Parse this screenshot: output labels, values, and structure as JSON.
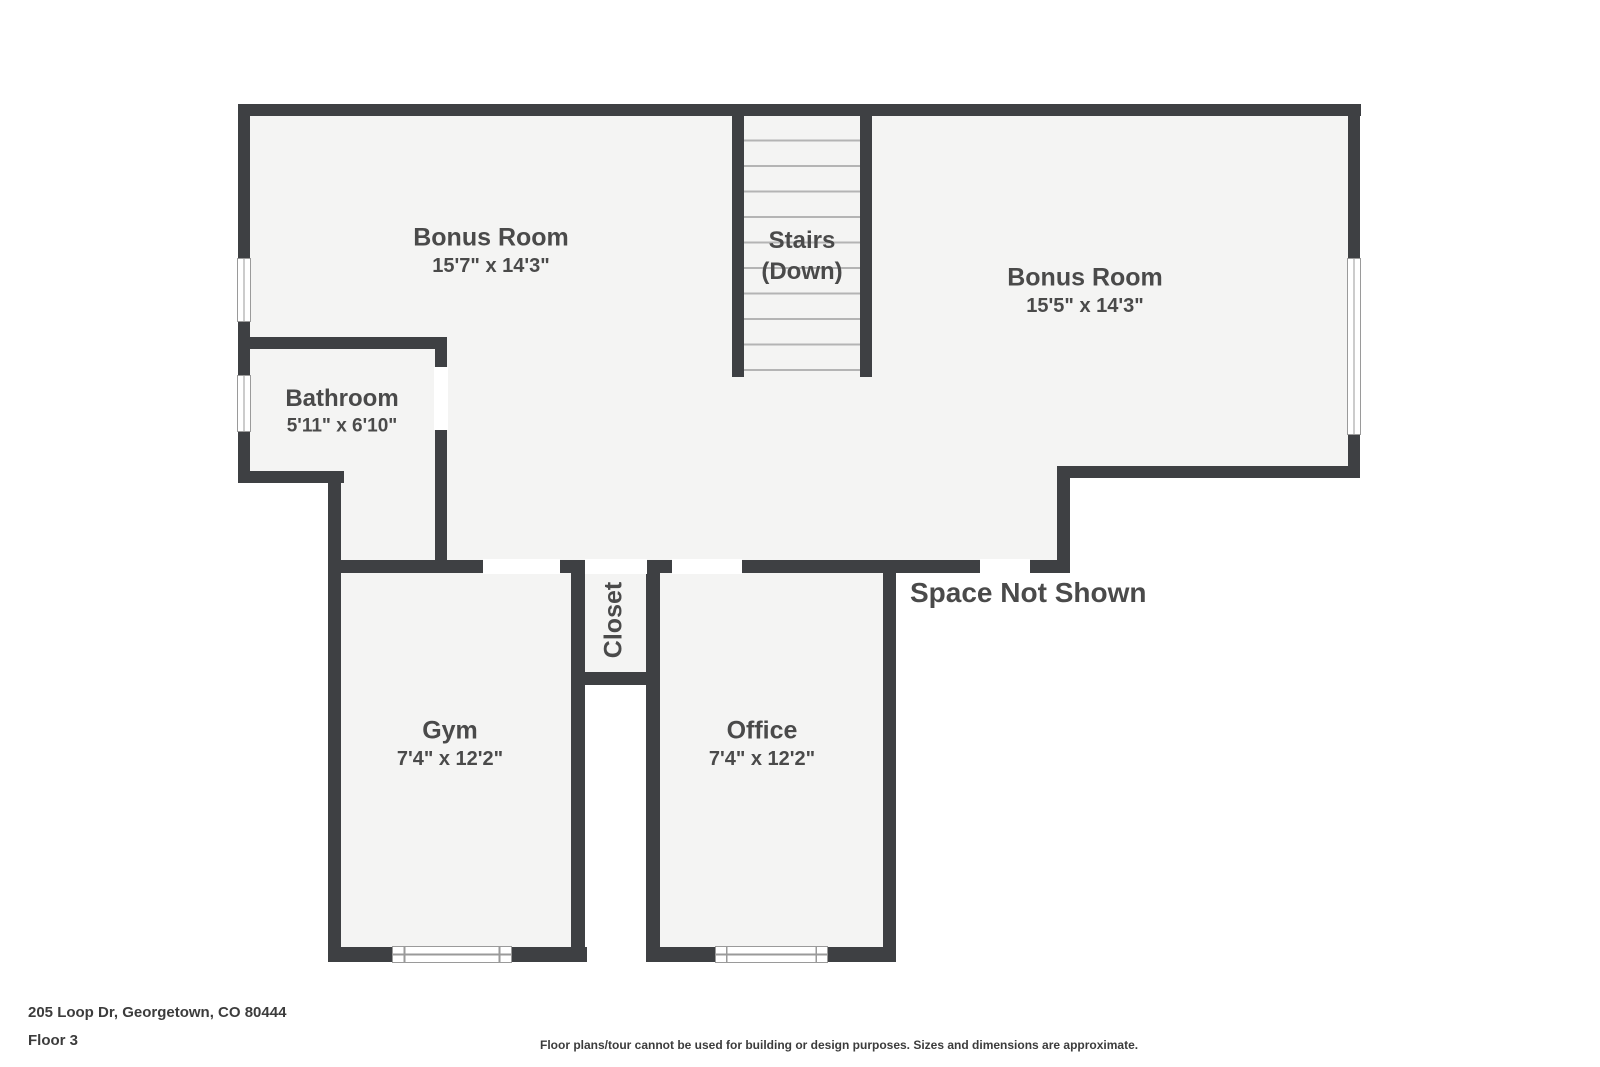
{
  "colors": {
    "wall": "#3E4043",
    "floor": "#F4F4F3",
    "tread": "#B4B4B4",
    "frame": "#9A9A9A",
    "label": "#4A4A4A",
    "footer": "#3C3C3C"
  },
  "rooms": {
    "bonus_left": {
      "name": "Bonus Room",
      "dims": "15'7\" x 14'3\""
    },
    "stairs": {
      "name": "Stairs",
      "sub": "(Down)"
    },
    "bonus_right": {
      "name": "Bonus Room",
      "dims": "15'5\" x 14'3\""
    },
    "bathroom": {
      "name": "Bathroom",
      "dims": "5'11\" x 6'10\""
    },
    "closet": {
      "name": "Closet"
    },
    "gym": {
      "name": "Gym",
      "dims": "7'4\" x 12'2\""
    },
    "office": {
      "name": "Office",
      "dims": "7'4\" x 12'2\""
    }
  },
  "annotations": {
    "space_not_shown": "Space Not Shown"
  },
  "footer": {
    "address": "205 Loop Dr, Georgetown, CO 80444",
    "floor_label": "Floor 3",
    "disclaimer": "Floor plans/tour cannot be used for building or design purposes. Sizes and dimensions are approximate."
  }
}
